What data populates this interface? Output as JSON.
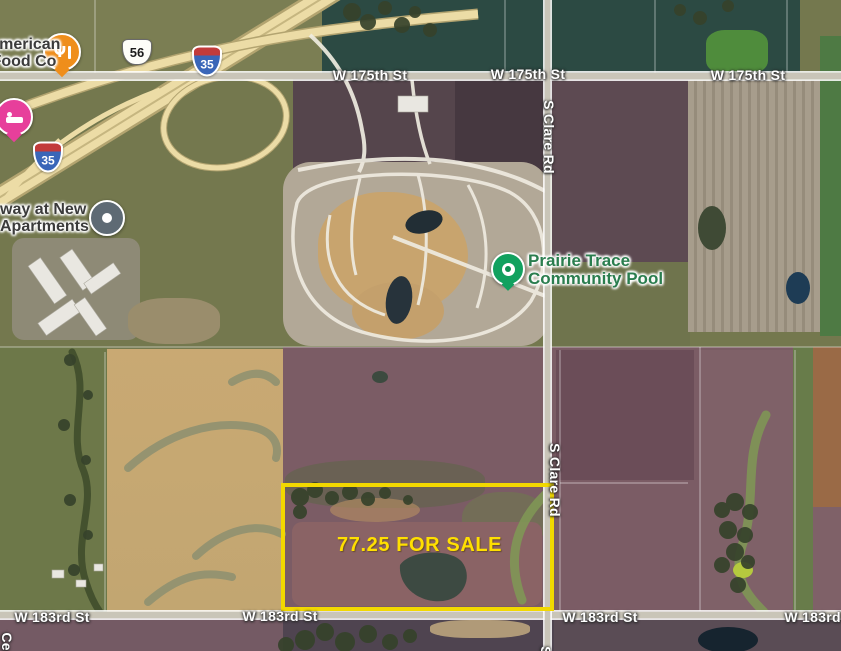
{
  "app": {
    "name": "satellite-map-view"
  },
  "roads": {
    "w175th": "W 175th St",
    "w183rd": "W 183rd St",
    "s_clare": "S Clare Rd",
    "cedar_partial": "Ced",
    "clare_partial_s": "S"
  },
  "highways": {
    "us_route": "56",
    "interstate": "35"
  },
  "pois": {
    "american_food": {
      "line1": "American",
      "line2": "Food Co",
      "icon": "restaurant-icon"
    },
    "new_apartments": {
      "line1": "way at New",
      "line2": "Apartments",
      "icon": "place-icon"
    },
    "community_pool": {
      "line1": "Prairie Trace",
      "line2": "Community Pool",
      "icon": "pool-icon"
    },
    "hotel": {
      "icon": "hotel-icon"
    }
  },
  "listing": {
    "label": "77.25 FOR SALE"
  },
  "colors": {
    "parcel_outline": "#f2d800",
    "sale_text": "#ffdf00",
    "poi_label_dark": "#3b3b3b",
    "pool_label_green": "#2a7d4e",
    "pin_orange": "#ef8e1b",
    "pin_magenta": "#e73f9b",
    "pin_green": "#12a15f",
    "pin_slate": "#5e6a74",
    "highway_yellow": "#ecdca6",
    "road_gray": "#c9c5b8",
    "interstate_blue": "#3a66b8",
    "interstate_red": "#c23b3b",
    "field_purple": "#7b5c65",
    "field_tan": "#c9a973",
    "field_olive": "#6f7a4c",
    "field_teal": "#2c4a43"
  }
}
